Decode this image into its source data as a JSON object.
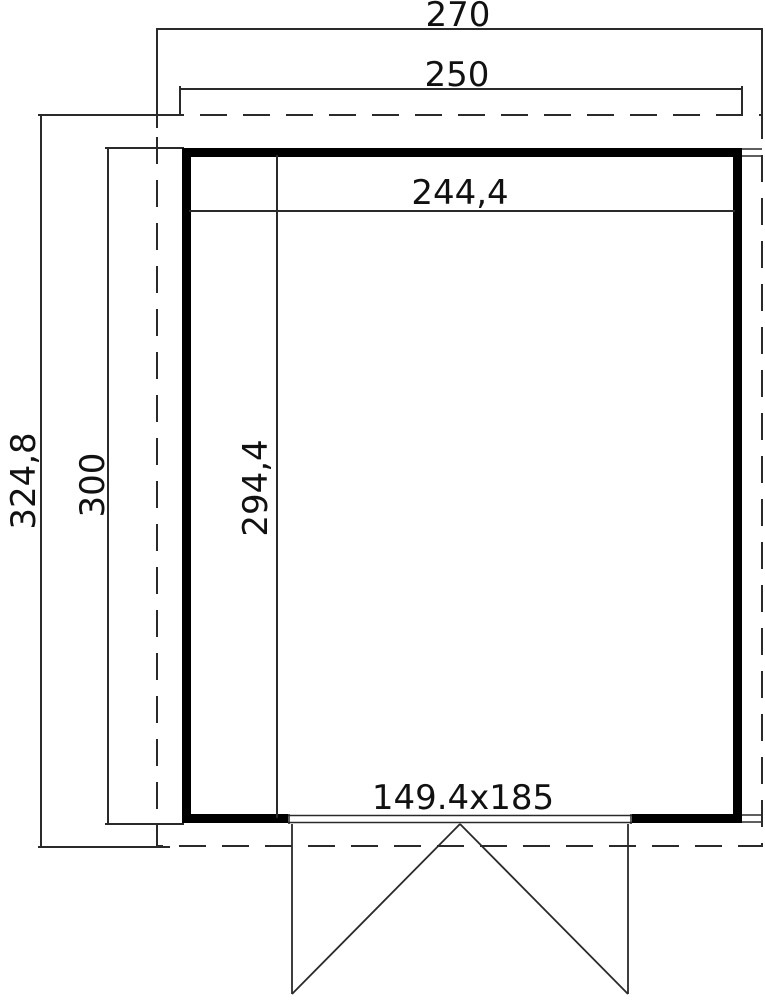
{
  "drawing": {
    "type": "floor-plan",
    "colors": {
      "background": "#ffffff",
      "wall": "#000000",
      "line": "#2a2a2a"
    },
    "labels": {
      "overall_width": "270",
      "base_width": "250",
      "interior_width": "244,4",
      "overall_depth": "324,8",
      "base_depth": "300",
      "interior_depth": "294,4",
      "door_size": "149.4x185"
    }
  }
}
